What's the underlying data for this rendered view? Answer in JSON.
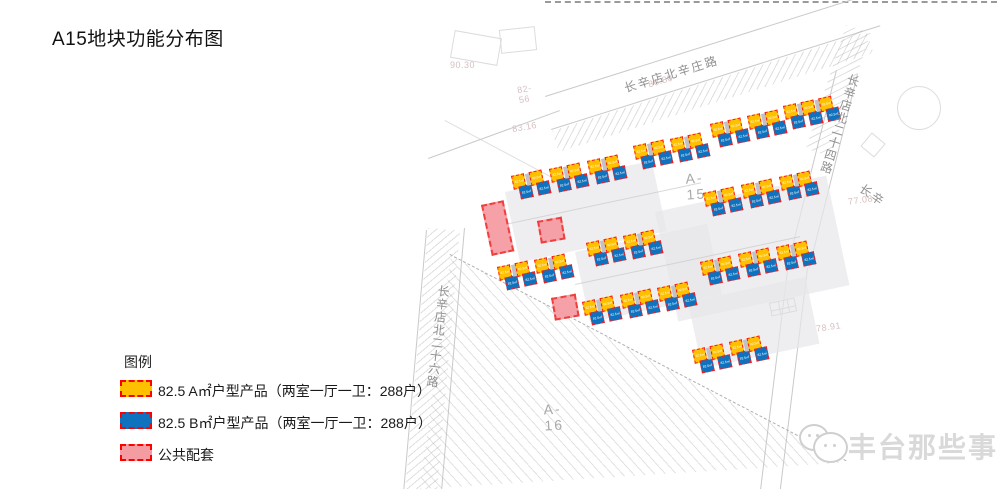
{
  "title": "A15地块功能分布图",
  "legend": {
    "heading": "图例",
    "items": [
      {
        "label": "82.5 A㎡户型产品（两室一厅一卫：288户）",
        "color": "#FFC000",
        "border": "#FF0000",
        "top": 380
      },
      {
        "label": "82.5 B㎡户型产品（两室一厅一卫：288户）",
        "color": "#0E72BE",
        "border": "#FF0000",
        "top": 412
      },
      {
        "label": "公共配套",
        "color": "#F59CA3",
        "border": "#FF0000",
        "top": 444
      }
    ]
  },
  "map": {
    "road_labels": [
      {
        "text": "长辛店北辛庄路",
        "x": 622,
        "y": 80,
        "rot": -17,
        "vertical": false
      },
      {
        "text": "长辛店北二十四路",
        "x": 847,
        "y": 72,
        "rot": 17,
        "vertical": true
      },
      {
        "text": "长辛",
        "x": 866,
        "y": 180,
        "rot": 35,
        "vertical": false
      },
      {
        "text": "长辛店北二十六路",
        "x": 436,
        "y": 284,
        "rot": 7,
        "vertical": true
      }
    ],
    "area_labels": [
      {
        "text": "A-15",
        "x": 686,
        "y": 170,
        "rot": -4
      },
      {
        "text": "A-16",
        "x": 544,
        "y": 401,
        "rot": -3
      }
    ],
    "ref_numbers": [
      {
        "text": "90.30",
        "x": 450,
        "y": 60,
        "rot": 0
      },
      {
        "text": "82-56",
        "x": 518,
        "y": 84,
        "rot": -10
      },
      {
        "text": "83.16",
        "x": 512,
        "y": 122,
        "rot": -10
      },
      {
        "text": "80.80",
        "x": 648,
        "y": 76,
        "rot": -17
      },
      {
        "text": "77.08",
        "x": 848,
        "y": 195,
        "rot": -8
      },
      {
        "text": "78.91",
        "x": 816,
        "y": 322,
        "rot": -8
      }
    ],
    "unit_label": "82.5㎡",
    "block_colors": {
      "type_a": "#FFC000",
      "type_b": "#0E72BE",
      "public": "#F59CA3",
      "dash_border": "#FF1A1A"
    },
    "clusters": [
      {
        "x": 511,
        "y": 176,
        "pairs": 2,
        "rot": -12
      },
      {
        "x": 549,
        "y": 169,
        "pairs": 2,
        "rot": -12
      },
      {
        "x": 587,
        "y": 161,
        "pairs": 2,
        "rot": -12
      },
      {
        "x": 633,
        "y": 146,
        "pairs": 2,
        "rot": -12
      },
      {
        "x": 670,
        "y": 139,
        "pairs": 2,
        "rot": -12
      },
      {
        "x": 710,
        "y": 124,
        "pairs": 2,
        "rot": -12
      },
      {
        "x": 747,
        "y": 116,
        "pairs": 2,
        "rot": -12
      },
      {
        "x": 783,
        "y": 106,
        "pairs": 3,
        "rot": -12
      },
      {
        "x": 703,
        "y": 193,
        "pairs": 2,
        "rot": -12
      },
      {
        "x": 741,
        "y": 185,
        "pairs": 2,
        "rot": -12
      },
      {
        "x": 779,
        "y": 177,
        "pairs": 2,
        "rot": -12
      },
      {
        "x": 586,
        "y": 243,
        "pairs": 2,
        "rot": -12
      },
      {
        "x": 623,
        "y": 236,
        "pairs": 2,
        "rot": -12
      },
      {
        "x": 497,
        "y": 267,
        "pairs": 2,
        "rot": -12
      },
      {
        "x": 534,
        "y": 260,
        "pairs": 2,
        "rot": -12
      },
      {
        "x": 700,
        "y": 262,
        "pairs": 2,
        "rot": -12
      },
      {
        "x": 738,
        "y": 254,
        "pairs": 2,
        "rot": -12
      },
      {
        "x": 776,
        "y": 247,
        "pairs": 2,
        "rot": -12
      },
      {
        "x": 582,
        "y": 302,
        "pairs": 2,
        "rot": -12
      },
      {
        "x": 620,
        "y": 295,
        "pairs": 2,
        "rot": -12
      },
      {
        "x": 657,
        "y": 288,
        "pairs": 2,
        "rot": -12
      },
      {
        "x": 692,
        "y": 350,
        "pairs": 2,
        "rot": -12
      },
      {
        "x": 729,
        "y": 342,
        "pairs": 2,
        "rot": -12
      }
    ],
    "public_facilities": [
      {
        "x": 481,
        "y": 205,
        "w": 23,
        "h": 52,
        "rot": -12
      },
      {
        "x": 537,
        "y": 221,
        "w": 25,
        "h": 23,
        "rot": -10
      },
      {
        "x": 551,
        "y": 298,
        "w": 25,
        "h": 23,
        "rot": -10
      }
    ]
  },
  "watermark": {
    "text": "丰台那些事"
  }
}
